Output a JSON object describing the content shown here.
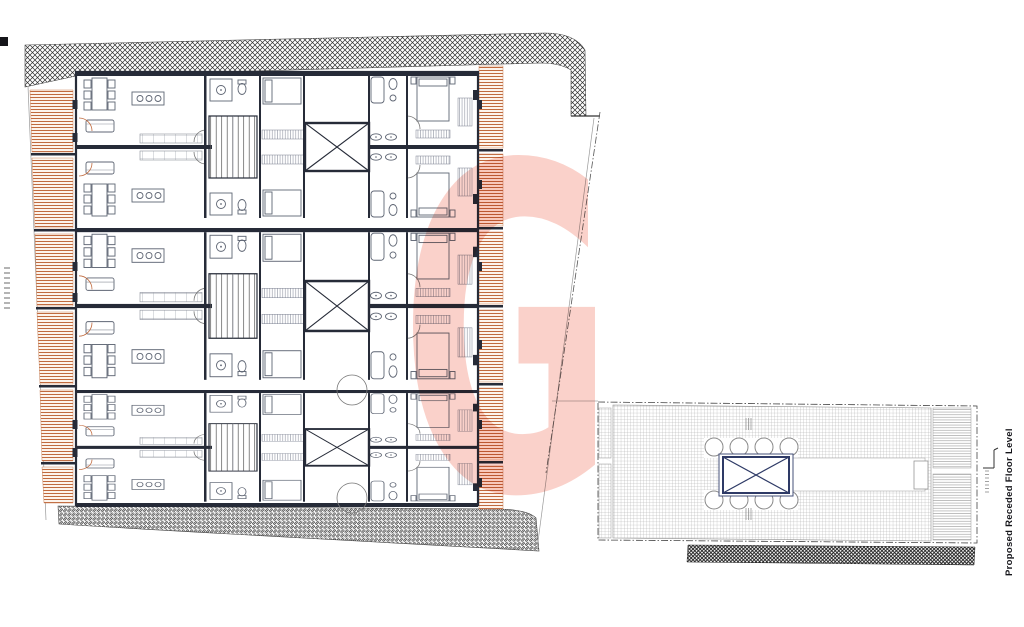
{
  "sheet": {
    "side_label": "Proposed Receded Floor Level",
    "watermark_letter": "G"
  },
  "colors": {
    "paper": "#ffffff",
    "line_ink": "#262b38",
    "furniture_ink": "#5f6674",
    "party_wall_hatch": "#2f2f2f",
    "balcony_hatch_orange": "#c06a3e",
    "roof_hatch_grey": "#a6a6a6",
    "roof_lift_navy": "#2e3a66",
    "watermark_pink": "#f07863"
  },
  "plan_features": {
    "apartment_clusters": 3,
    "flats_per_cluster": 2,
    "lift_shafts_main_plan": 3,
    "roof_plan_circles": 8
  },
  "notes": {
    "illegible_microtext_locations": [
      "left margin vertical note",
      "section marker note near roof plan",
      "roof plan dimension ticks"
    ]
  }
}
